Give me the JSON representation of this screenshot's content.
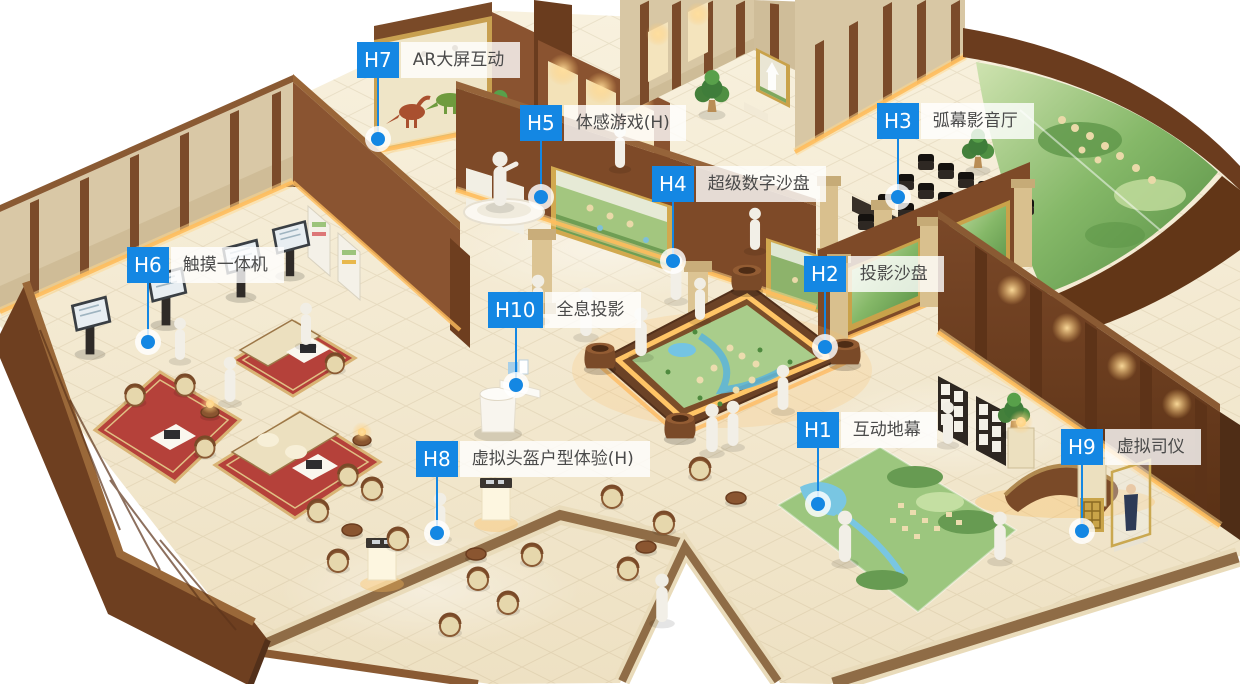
{
  "style": {
    "accent": "#1487e3",
    "badge_text_color": "#ffffff",
    "label_bg": "rgba(255,255,255,0.80)",
    "label_text_color": "#4a4a4a"
  },
  "hotspots": [
    {
      "id": "H1",
      "label": "互动地幕",
      "x": 797,
      "y": 412,
      "dot_y": 504
    },
    {
      "id": "H2",
      "label": "投影沙盘",
      "x": 804,
      "y": 256,
      "dot_y": 347
    },
    {
      "id": "H3",
      "label": "弧幕影音厅",
      "x": 877,
      "y": 103,
      "dot_y": 197
    },
    {
      "id": "H4",
      "label": "超级数字沙盘",
      "x": 652,
      "y": 166,
      "dot_y": 261
    },
    {
      "id": "H5",
      "label": "体感游戏(H)",
      "x": 520,
      "y": 105,
      "dot_y": 197
    },
    {
      "id": "H6",
      "label": "触摸一体机",
      "x": 127,
      "y": 247,
      "dot_y": 342
    },
    {
      "id": "H7",
      "label": "AR大屏互动",
      "x": 357,
      "y": 42,
      "dot_y": 139
    },
    {
      "id": "H8",
      "label": "虚拟头盔户型体验(H)",
      "x": 416,
      "y": 441,
      "dot_y": 533
    },
    {
      "id": "H9",
      "label": "虚拟司仪",
      "x": 1061,
      "y": 429,
      "dot_y": 531
    },
    {
      "id": "H10",
      "label": "全息投影",
      "x": 488,
      "y": 292,
      "dot_y": 385
    }
  ]
}
